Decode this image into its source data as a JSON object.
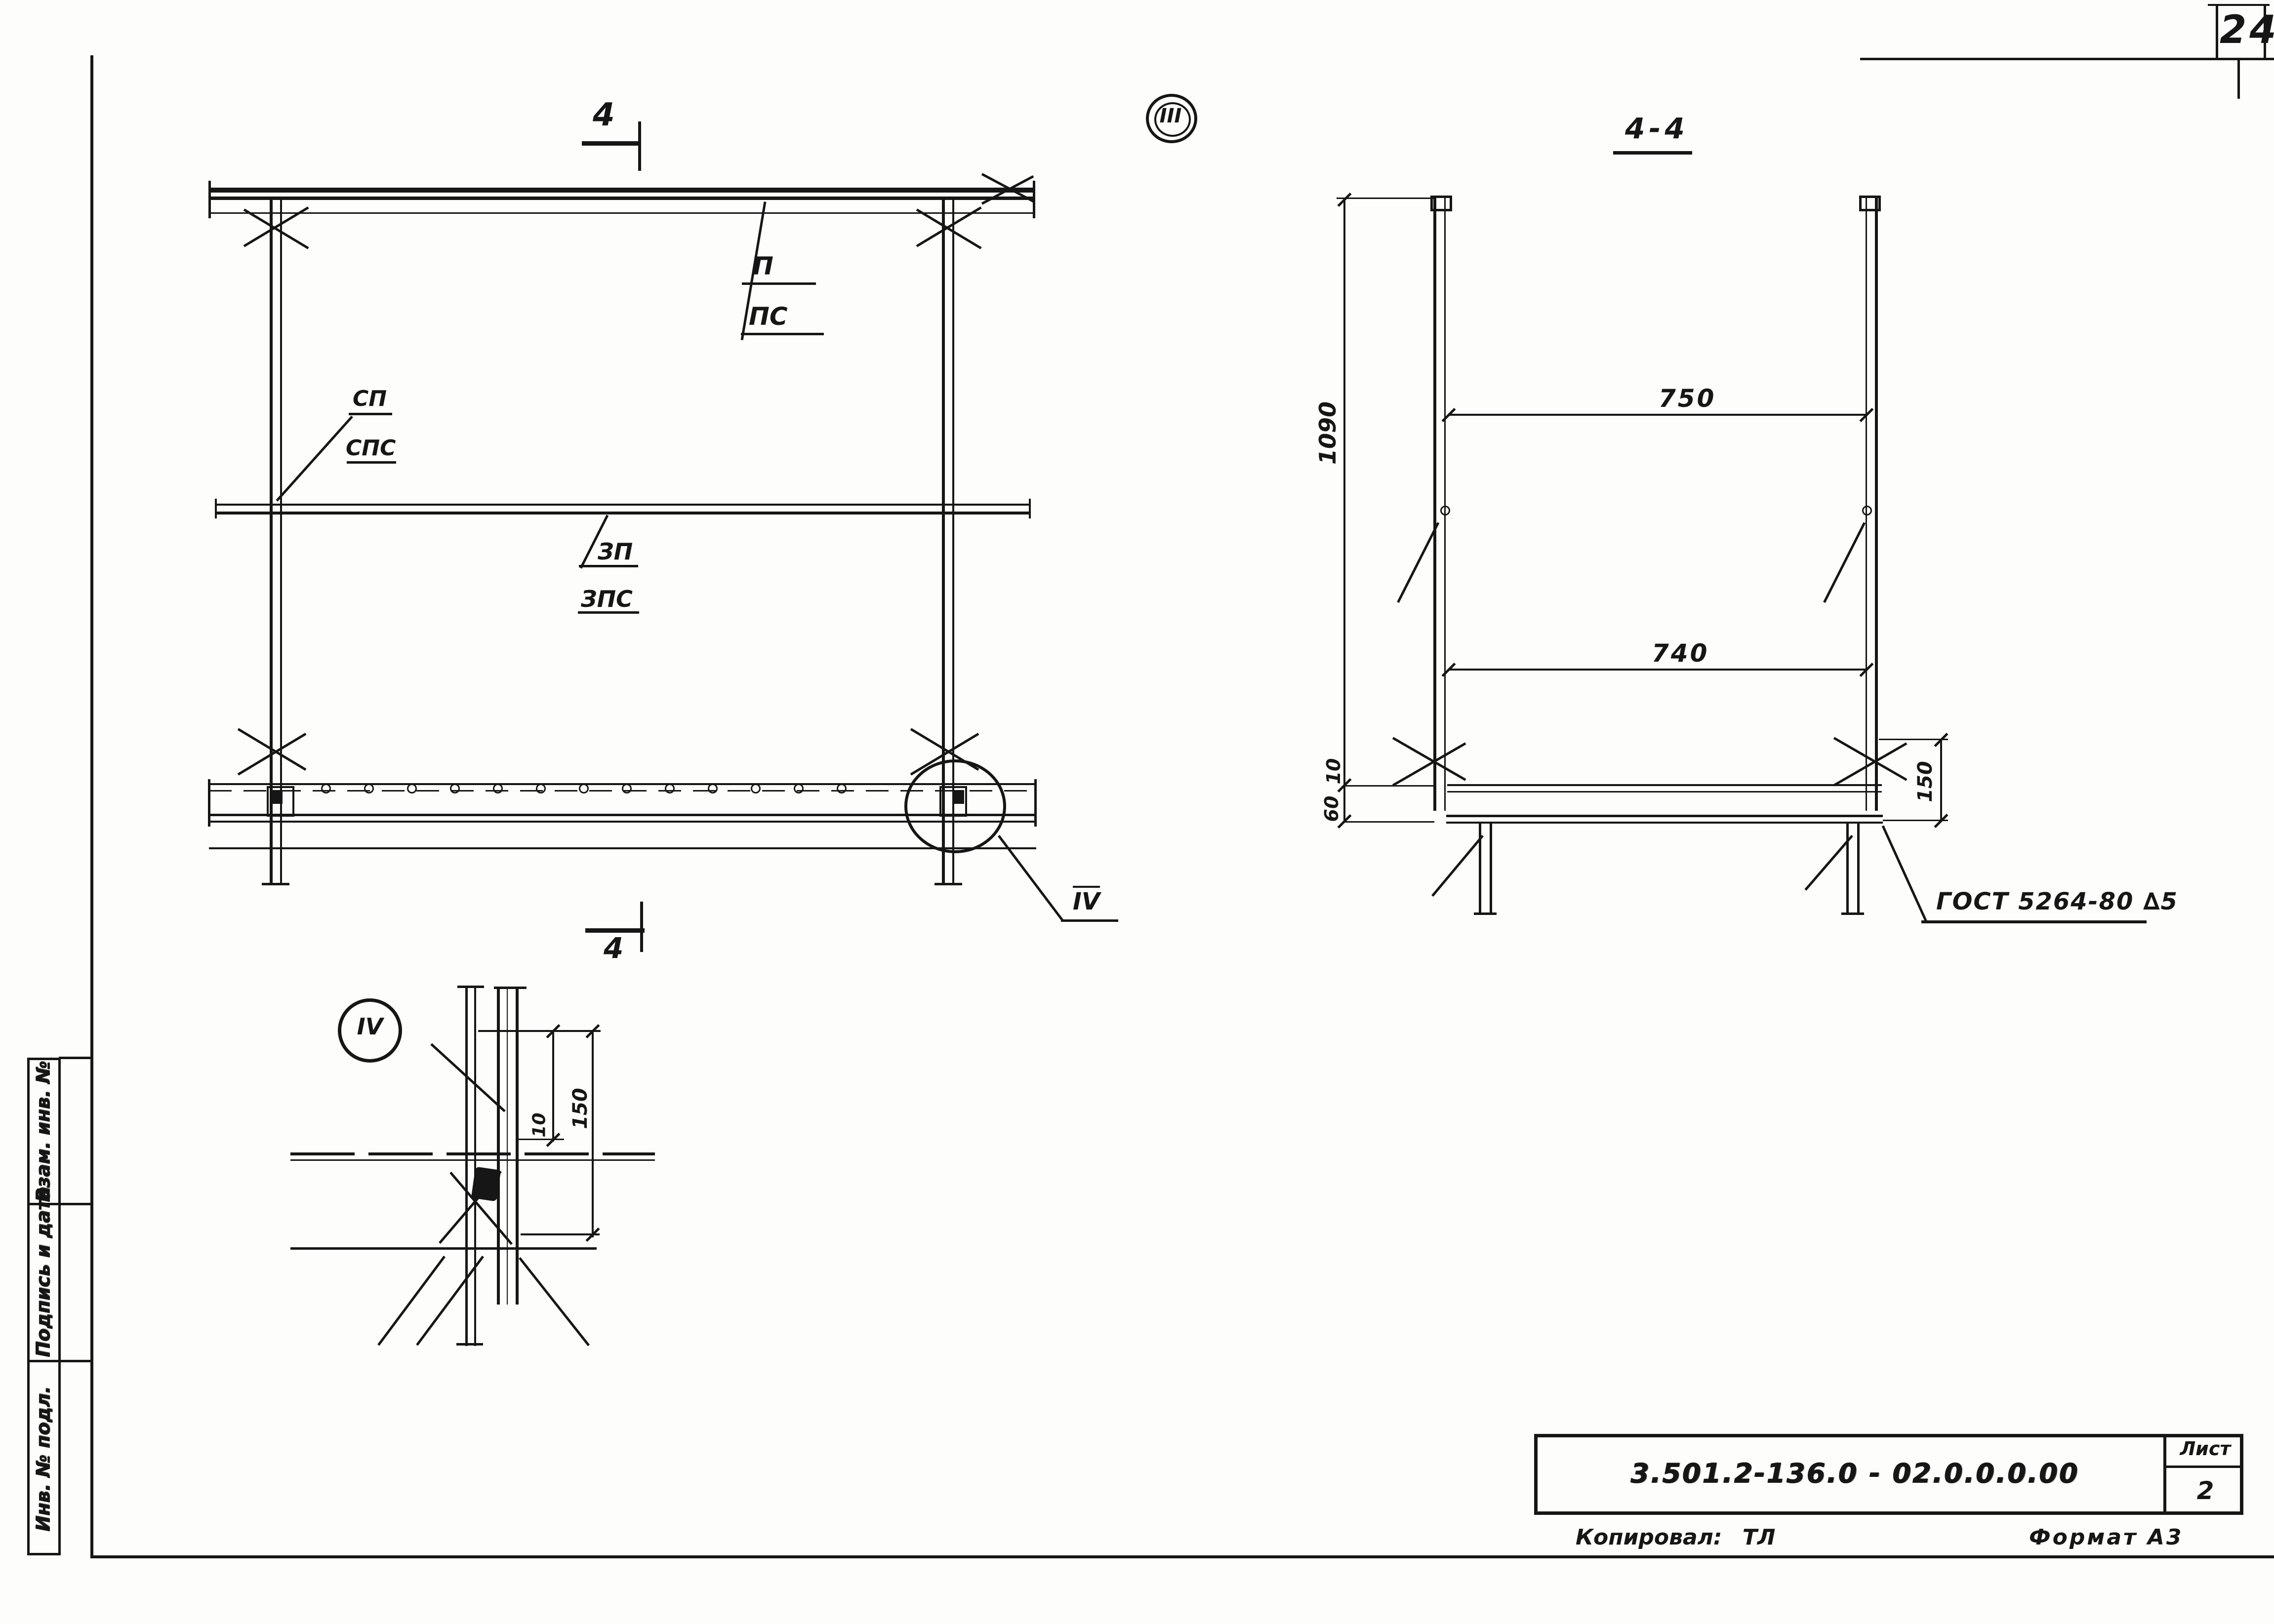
{
  "sheet": {
    "page_number": "24",
    "title_block": {
      "doc_number": "3.501.2-136.0 - 02.0.0.0.00",
      "sheet_label": "Лист",
      "sheet_value": "2"
    },
    "copied_label": "Копировал:",
    "copied_signature": "ТЛ",
    "format_note": "Формат А3",
    "margin_stamps": [
      {
        "label": "Взам. инв. №"
      },
      {
        "label": "Подпись и дата"
      },
      {
        "label": "Инв. № подл."
      }
    ]
  },
  "front_view": {
    "section_cut_top": "4",
    "section_cut_bottom": "4",
    "view_ref": "III",
    "node_ref": "IV",
    "callout_1": {
      "top": "П",
      "bottom": "ПС"
    },
    "callout_2": {
      "top": "СП",
      "bottom": "СПС"
    },
    "callout_3": {
      "top": "ЗП",
      "bottom": "ЗПС"
    }
  },
  "section_view": {
    "title": "4-4",
    "dim_width_top": "750",
    "dim_width_mid": "740",
    "dim_height": "1090",
    "dim_gap": "10",
    "dim_base": "60",
    "dim_right": "150",
    "weld_note": "ГОСТ 5264-80 ∆5"
  },
  "detail_view": {
    "node_ref": "IV",
    "dim_inner": "10",
    "dim_outer": "150"
  }
}
